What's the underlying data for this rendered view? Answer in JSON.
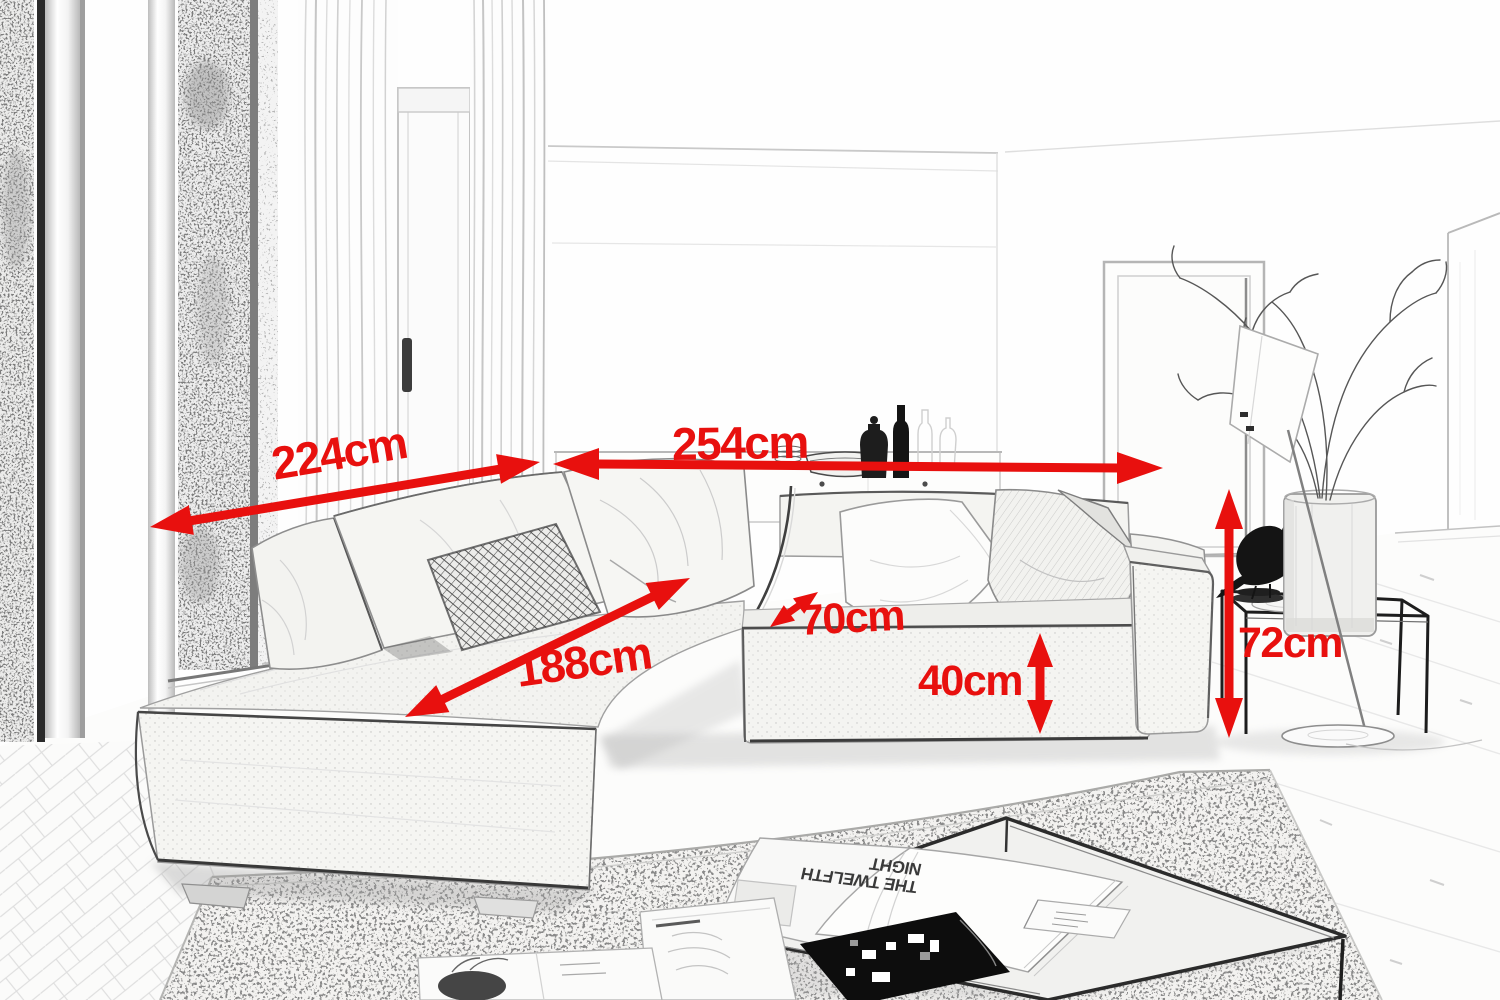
{
  "annotations": {
    "arrow_color": "#e8100e",
    "unit": "cm",
    "dimensions": [
      {
        "id": "back-width-left",
        "label": "224cm",
        "value": 224,
        "unit": "cm",
        "orientation": "diagonal"
      },
      {
        "id": "back-width-right",
        "label": "254cm",
        "value": 254,
        "unit": "cm",
        "orientation": "horizontal"
      },
      {
        "id": "chaise-length",
        "label": "188cm",
        "value": 188,
        "unit": "cm",
        "orientation": "diagonal"
      },
      {
        "id": "seat-depth",
        "label": "70cm",
        "value": 70,
        "unit": "cm",
        "orientation": "diagonal"
      },
      {
        "id": "base-height",
        "label": "40cm",
        "value": 40,
        "unit": "cm",
        "orientation": "vertical"
      },
      {
        "id": "total-height",
        "label": "72cm",
        "value": 72,
        "unit": "cm",
        "orientation": "vertical"
      }
    ]
  },
  "scene": {
    "magazine": {
      "title_line1": "THE TWELFTH",
      "title_line2": "NIGHT",
      "orientation": "upside-down"
    }
  }
}
